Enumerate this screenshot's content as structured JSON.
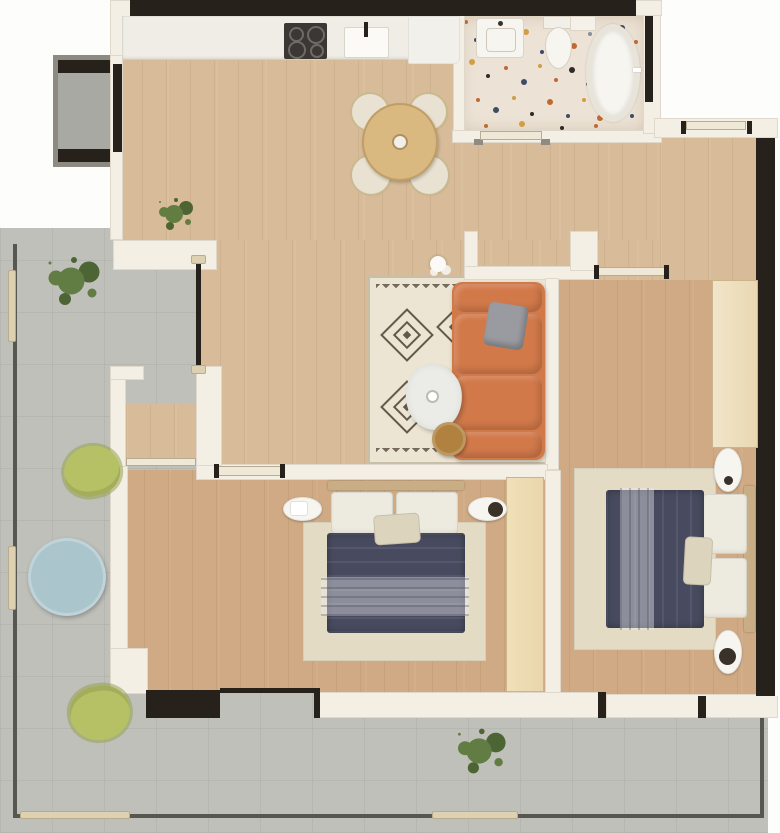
{
  "meta": {
    "type": "architectural-floor-plan",
    "view": "top-down 3D rendered apartment plan",
    "units_text_visible": false
  },
  "colors": {
    "outside": "#fdfdfc",
    "wall": "#f4efe5",
    "dark": "#27211b",
    "wood": "#d8bc99",
    "wood_dark": "#cfaa84",
    "tile": "#bfc0ba",
    "tile_small": "#a9a9a3",
    "terrazzo": "#ece3d6",
    "counter": "#f0ede6",
    "appliance": "#3a3734",
    "sofa": "#d2794a",
    "rug": "#ede5d3",
    "rug_pattern": "#4c4134",
    "navy": "#484b5f",
    "pillow": "#edebe0",
    "cream_pillow": "#dcd4bd",
    "bed_rug": "#e3dbc4",
    "closet": "#e9d6ac",
    "closet_light": "#f1e5c9",
    "headboard": "#c9ae85",
    "marble": "#ebebe7",
    "side_table": "#b0813f",
    "dining_table": "#d9b97f",
    "chair": "#e9e2d2",
    "blue_table": "#abc5cc",
    "green_chair": "#b6c165",
    "plant": "#5d7a3d",
    "plant_dark": "#47602e",
    "railing": "#57564f",
    "railing_post": "#ddd1b2",
    "white_fixture": "#f7f5f0",
    "door_leaf": "#efe8d7"
  },
  "rooms": [
    {
      "id": "kitchen",
      "items": [
        {
          "name": "kitchen-counter",
          "count": 1
        },
        {
          "name": "cooktop",
          "count": 1,
          "burners": 4
        },
        {
          "name": "kitchen-sink",
          "count": 1
        },
        {
          "name": "dining-table-round",
          "count": 1
        },
        {
          "name": "dining-chair",
          "count": 4
        },
        {
          "name": "potted-plant",
          "count": 1
        }
      ]
    },
    {
      "id": "living-room",
      "items": [
        {
          "name": "geometric-area-rug",
          "count": 1
        },
        {
          "name": "corner-sofa-orange",
          "count": 1
        },
        {
          "name": "throw-pillow-gray",
          "count": 1
        },
        {
          "name": "marble-coffee-table",
          "count": 1
        },
        {
          "name": "round-side-table",
          "count": 1
        },
        {
          "name": "white-vase",
          "count": 1
        }
      ]
    },
    {
      "id": "bathroom",
      "items": [
        {
          "name": "washbasin",
          "count": 1
        },
        {
          "name": "toilet",
          "count": 1
        },
        {
          "name": "bathtub-oval",
          "count": 1
        },
        {
          "name": "terrazzo-floor",
          "count": 1
        }
      ]
    },
    {
      "id": "hallway",
      "items": [
        {
          "name": "bedroom-door",
          "count": 1
        },
        {
          "name": "entry-door",
          "count": 1
        },
        {
          "name": "ceiling-light",
          "count": 2
        }
      ]
    },
    {
      "id": "bedroom-right",
      "items": [
        {
          "name": "double-bed-navy",
          "count": 1
        },
        {
          "name": "bed-pillow",
          "count": 3
        },
        {
          "name": "nightstand",
          "count": 2
        },
        {
          "name": "wardrobe",
          "count": 1
        },
        {
          "name": "bed-rug",
          "count": 1
        }
      ]
    },
    {
      "id": "bedroom-left",
      "items": [
        {
          "name": "double-bed-navy",
          "count": 1
        },
        {
          "name": "bed-pillow",
          "count": 3
        },
        {
          "name": "nightstand",
          "count": 2
        },
        {
          "name": "wardrobe",
          "count": 1
        },
        {
          "name": "bed-rug",
          "count": 1
        }
      ]
    },
    {
      "id": "terrace",
      "items": [
        {
          "name": "round-table-blue",
          "count": 1
        },
        {
          "name": "lounge-chair-green",
          "count": 2
        },
        {
          "name": "potted-plant",
          "count": 2
        },
        {
          "name": "railing",
          "count": 1
        },
        {
          "name": "entry-deck-mat",
          "count": 1
        }
      ]
    },
    {
      "id": "balcony-small",
      "items": []
    }
  ]
}
